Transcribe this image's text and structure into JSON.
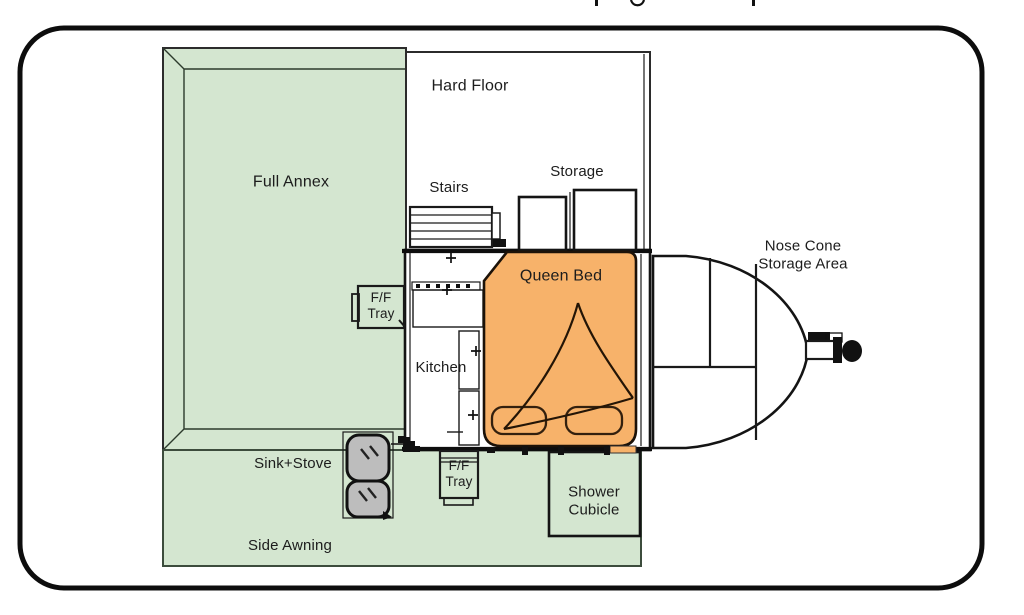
{
  "colors": {
    "annex_green": "#d4e6d0",
    "bed_orange": "#f7b26a",
    "sink_gray": "#bdbdbd",
    "outline_black": "#111111",
    "label_text": "#1c1c1c"
  },
  "plan": {
    "full_annex": {
      "label": "Full Annex"
    },
    "hard_floor": {
      "label": "Hard Floor"
    },
    "stairs": {
      "label": "Stairs"
    },
    "storage": {
      "label": "Storage"
    },
    "queen_bed": {
      "label": "Queen Bed"
    },
    "nose_cone": {
      "line1": "Nose Cone",
      "line2": "Storage Area"
    },
    "kitchen": {
      "label": "Kitchen"
    },
    "ff_tray_upper": {
      "line1": "F/F",
      "line2": "Tray"
    },
    "ff_tray_lower": {
      "line1": "F/F",
      "line2": "Tray"
    },
    "sink_stove": {
      "label": "Sink+Stove"
    },
    "side_awning": {
      "label": "Side Awning"
    },
    "shower": {
      "line1": "Shower",
      "line2": "Cubicle"
    }
  },
  "artifacts": {
    "top_edge_glyph_fragments": [
      "p-stem",
      "g-loop",
      "p-stem"
    ]
  }
}
